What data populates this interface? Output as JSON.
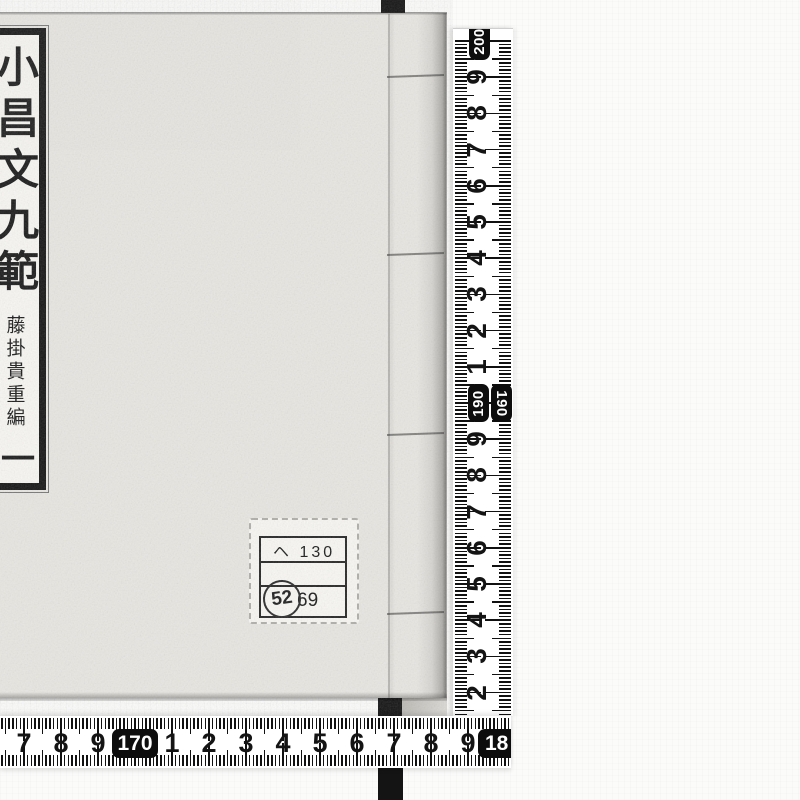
{
  "colors": {
    "paper": "#e8e6e1",
    "label_bg": "#f7f6f2",
    "ink": "#1b1b1b",
    "tape": "#ffffff",
    "tick": "#111111",
    "backdrop_strap": "#141414",
    "background": "#fbfbfa"
  },
  "book": {
    "title_label": {
      "title": "小昌文九範",
      "editor": "藤掛貴重編",
      "volume_mark": "一"
    },
    "sticker": {
      "row1": "ヘ 130",
      "row2": "",
      "row3": "69",
      "stamp": "52"
    }
  },
  "rulers": {
    "vertical": {
      "unit": "cm",
      "range_visible": [
        182,
        200
      ],
      "labels": [
        {
          "value": 200,
          "text": "200",
          "boxed": true
        },
        {
          "value": 199,
          "text": "9"
        },
        {
          "value": 198,
          "text": "8"
        },
        {
          "value": 197,
          "text": "7"
        },
        {
          "value": 196,
          "text": "6"
        },
        {
          "value": 195,
          "text": "5"
        },
        {
          "value": 194,
          "text": "4"
        },
        {
          "value": 193,
          "text": "3"
        },
        {
          "value": 192,
          "text": "2"
        },
        {
          "value": 191,
          "text": "1"
        },
        {
          "value": 190,
          "text": "190",
          "boxed": true
        },
        {
          "value": 189,
          "text": "9"
        },
        {
          "value": 188,
          "text": "8"
        },
        {
          "value": 187,
          "text": "7"
        },
        {
          "value": 186,
          "text": "6"
        },
        {
          "value": 185,
          "text": "5"
        },
        {
          "value": 184,
          "text": "4"
        },
        {
          "value": 183,
          "text": "3"
        },
        {
          "value": 182,
          "text": "2"
        }
      ]
    },
    "horizontal": {
      "unit": "cm",
      "range_visible": [
        167,
        180
      ],
      "labels": [
        {
          "value": 167,
          "text": "7"
        },
        {
          "value": 168,
          "text": "8"
        },
        {
          "value": 169,
          "text": "9"
        },
        {
          "value": 170,
          "text": "170",
          "boxed": true
        },
        {
          "value": 171,
          "text": "1"
        },
        {
          "value": 172,
          "text": "2"
        },
        {
          "value": 173,
          "text": "3"
        },
        {
          "value": 174,
          "text": "4"
        },
        {
          "value": 175,
          "text": "5"
        },
        {
          "value": 176,
          "text": "6"
        },
        {
          "value": 177,
          "text": "7"
        },
        {
          "value": 178,
          "text": "8"
        },
        {
          "value": 179,
          "text": "9"
        },
        {
          "value": 180,
          "text": "18",
          "boxed": true
        }
      ]
    }
  }
}
